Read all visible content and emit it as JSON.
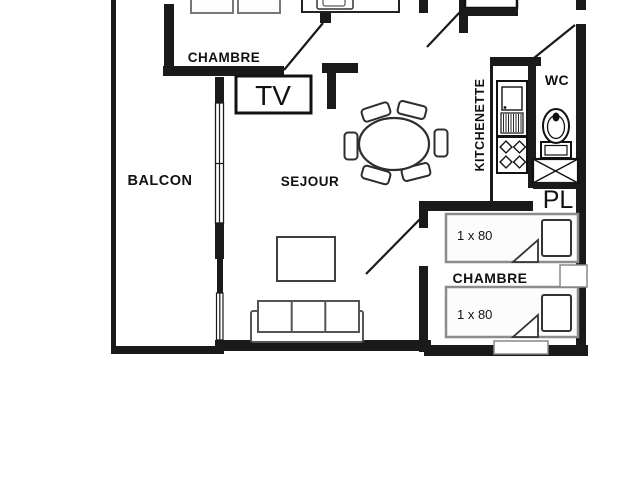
{
  "floorplan": {
    "rooms": {
      "balcony": {
        "label": "BALCON"
      },
      "bedroom_top": {
        "label": "CHAMBRE"
      },
      "living_room": {
        "label": "SEJOUR"
      },
      "kitchenette": {
        "label": "KITCHENETTE"
      },
      "wc": {
        "label": "WC"
      },
      "closet": {
        "label": "PL"
      },
      "bedroom_bottom": {
        "label": "CHAMBRE"
      }
    },
    "furniture": {
      "tv": {
        "label": "TV"
      },
      "bed_top": {
        "size_label": "1 x 80"
      },
      "bed_bottom": {
        "size_label": "1 x 80"
      }
    },
    "colors": {
      "background": "#ffffff",
      "wall": "#1a1a1a",
      "furniture_outline": "#2e2e2e",
      "bed_outline": "#8c8c8c",
      "sofa_outline": "#555555",
      "text": "#111111"
    }
  }
}
